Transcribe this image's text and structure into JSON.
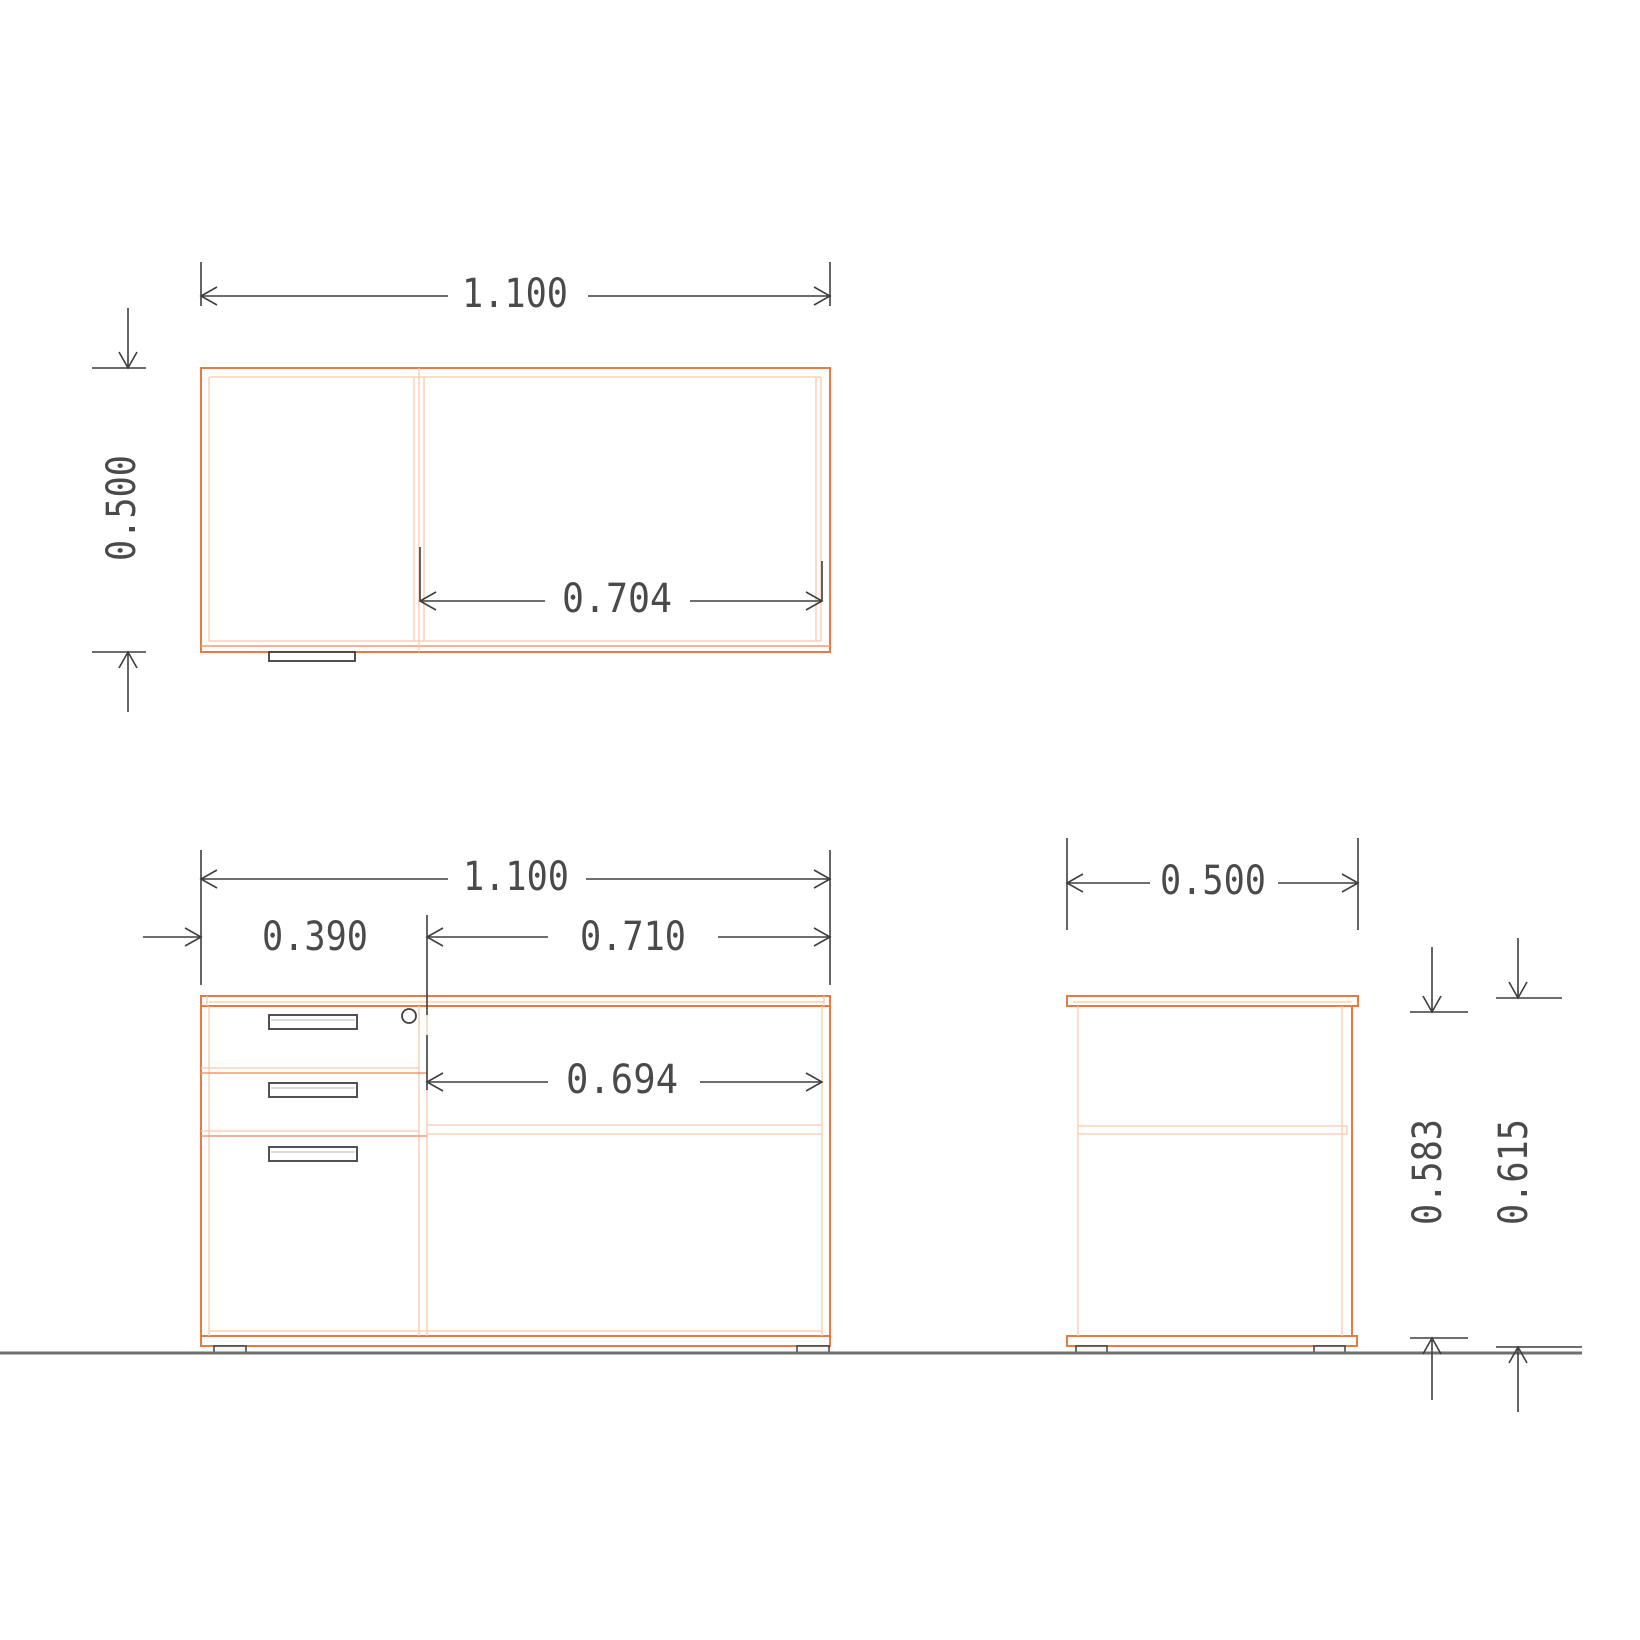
{
  "colors": {
    "line_strong": "#e87a45",
    "line_light": "#f7c9ad",
    "line_medium": "#f09a70",
    "ink": "#3f3f3f",
    "text": "#4a4a4a",
    "floor": "#6f6f6f",
    "background": "#ffffff"
  },
  "top_view": {
    "width": "1.100",
    "depth": "0.500",
    "opening_width": "0.704"
  },
  "front_view": {
    "width": "1.100",
    "pedestal_width": "0.390",
    "opening_width": "0.710",
    "inner_width": "0.694"
  },
  "side_view": {
    "depth": "0.500",
    "carcass_height": "0.583",
    "overall_height": "0.615"
  }
}
